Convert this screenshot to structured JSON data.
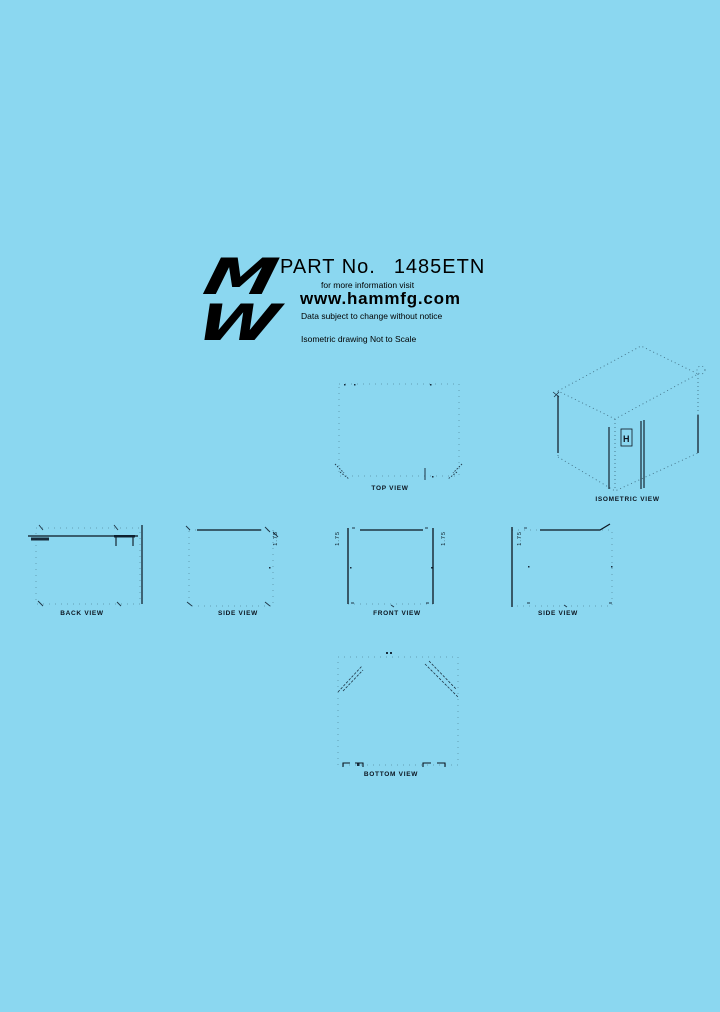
{
  "page": {
    "background": "#8bd7f0",
    "ink": "#0b1520"
  },
  "header": {
    "logo_top": "M",
    "logo_bottom": "W",
    "part_label": "PART No.",
    "part_number": "1485ETN",
    "info_line": "for more information visit",
    "website": "www.hammfg.com",
    "disclaimer": "Data subject to change without notice",
    "scale_note": "Isometric drawing Not to Scale"
  },
  "views": {
    "top": {
      "label": "TOP VIEW"
    },
    "isometric": {
      "label": "ISOMETRIC VIEW",
      "panel_mark": "H"
    },
    "back": {
      "label": "BACK VIEW"
    },
    "side_left": {
      "label": "SIDE VIEW",
      "dim": "1.75"
    },
    "front": {
      "label": "FRONT VIEW",
      "dim_left": "1.75",
      "dim_right": "1.75"
    },
    "side_right": {
      "label": "SIDE VIEW",
      "dim": "1.75"
    },
    "bottom": {
      "label": "BOTTOM VIEW"
    }
  }
}
